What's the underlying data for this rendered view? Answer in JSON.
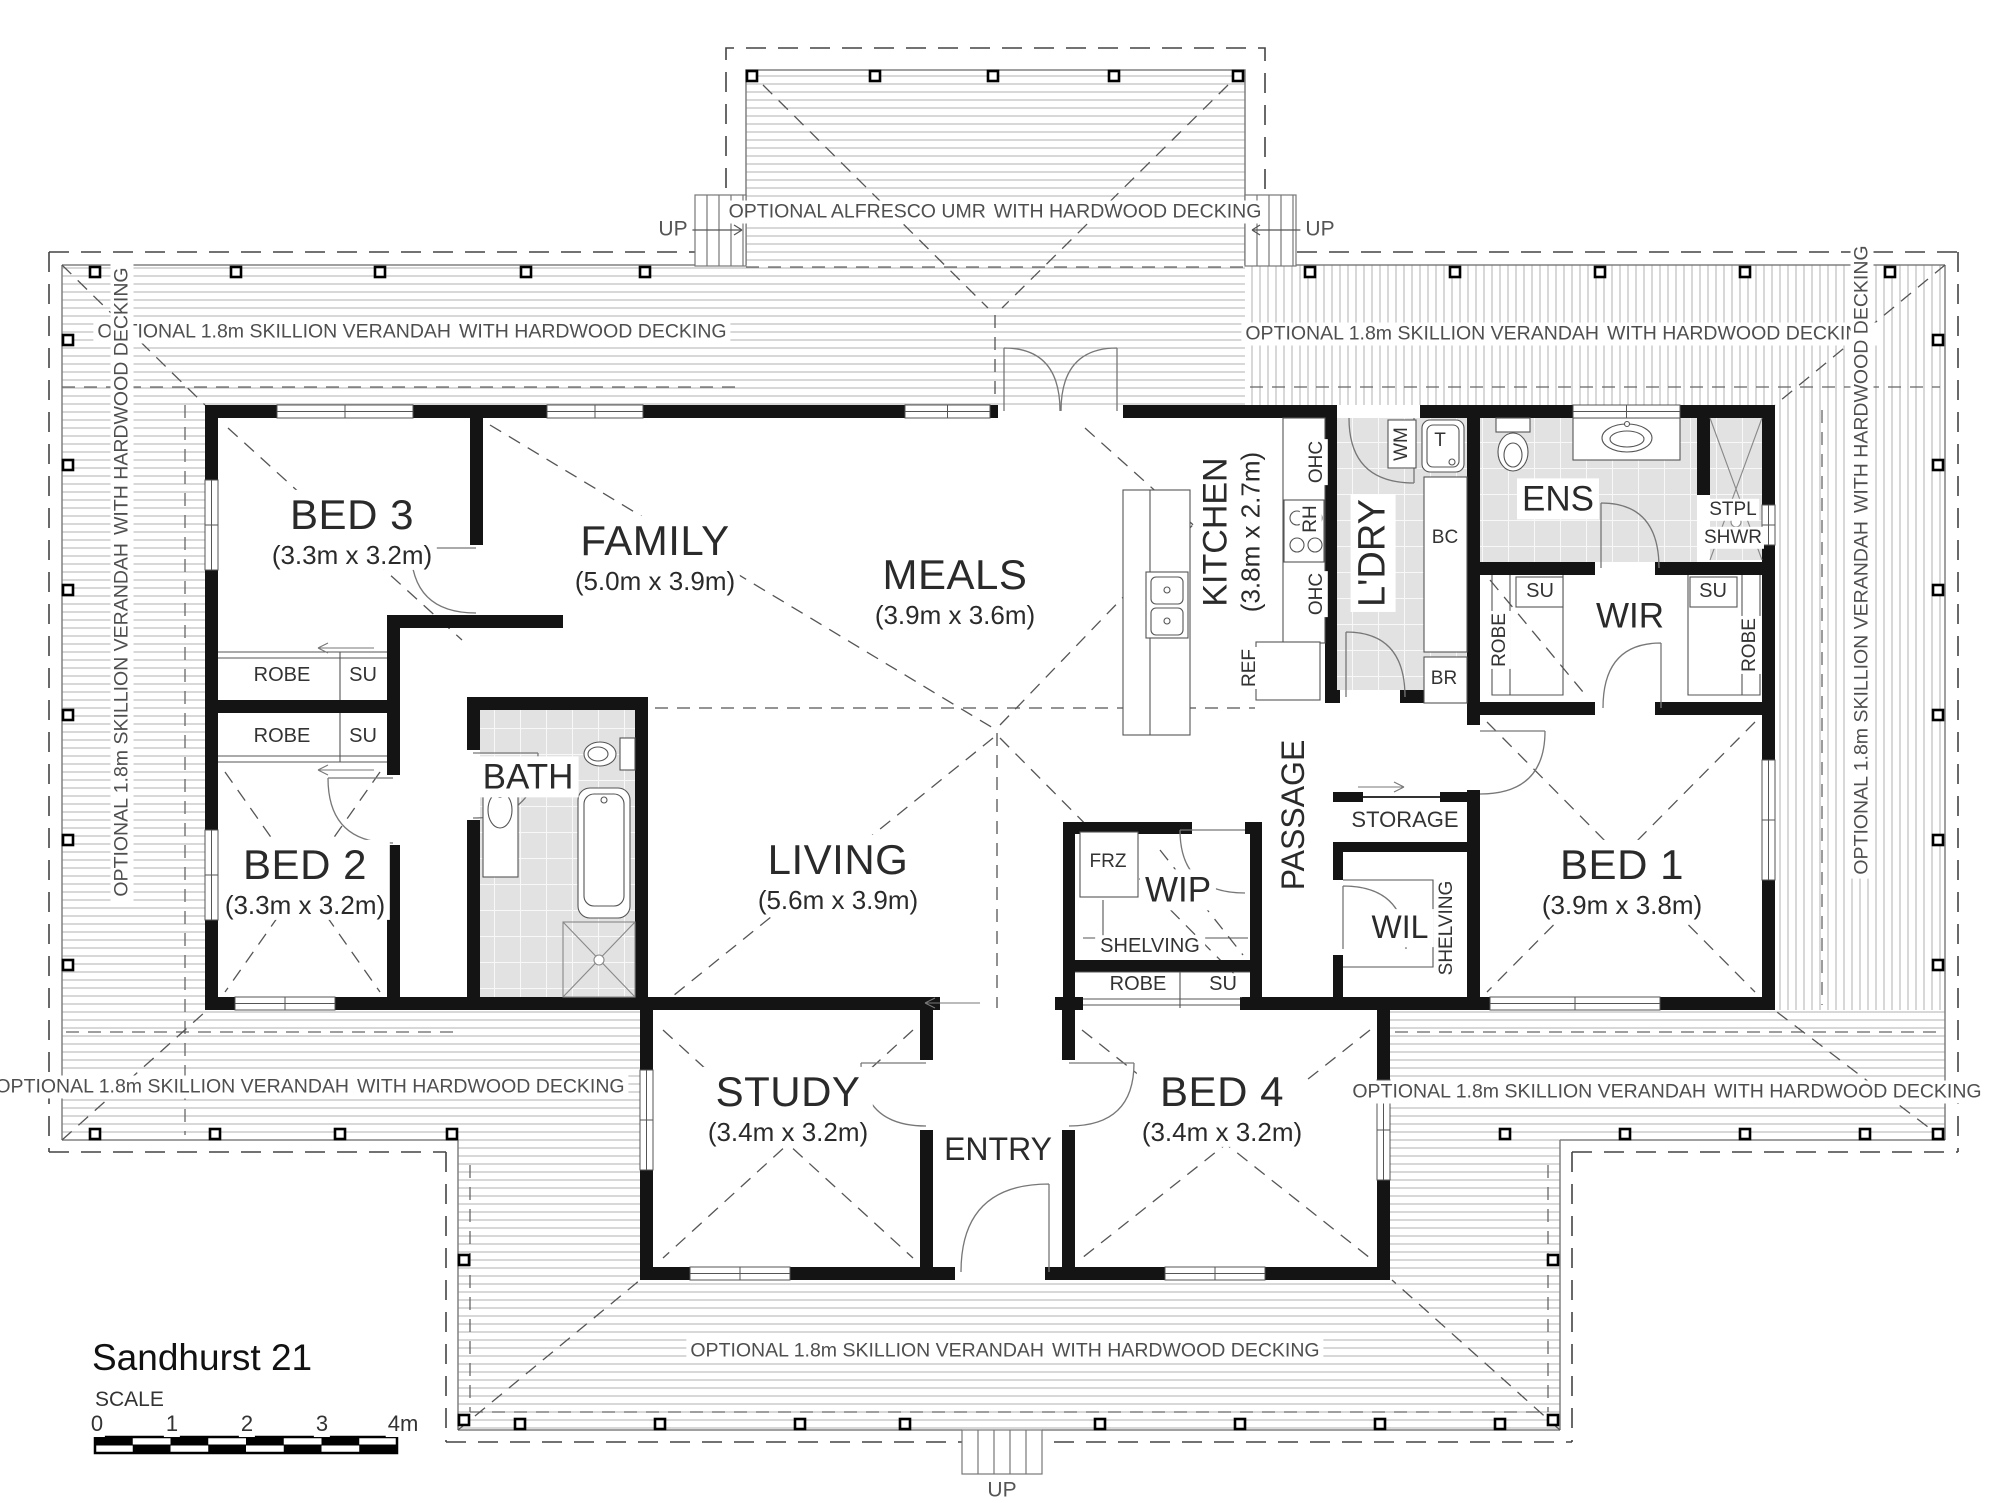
{
  "title": "Sandhurst 21",
  "scale": {
    "label": "SCALE",
    "ticks": [
      "0",
      "1",
      "2",
      "3",
      "4m"
    ]
  },
  "verandah": {
    "line1": "OPTIONAL 1.8m SKILLION VERANDAH",
    "line2": "WITH HARDWOOD DECKING"
  },
  "alfresco": {
    "line1": "OPTIONAL ALFRESCO UMR",
    "line2": "WITH HARDWOOD DECKING"
  },
  "stairs": {
    "up": "UP"
  },
  "rooms": {
    "bed3": {
      "name": "BED 3",
      "dims": "(3.3m x 3.2m)"
    },
    "family": {
      "name": "FAMILY",
      "dims": "(5.0m x 3.9m)"
    },
    "meals": {
      "name": "MEALS",
      "dims": "(3.9m x 3.6m)"
    },
    "kitchen": {
      "name": "KITCHEN",
      "dims": "(3.8m x 2.7m)"
    },
    "laundry": {
      "name": "L'DRY"
    },
    "ens": {
      "name": "ENS"
    },
    "wir": {
      "name": "WIR"
    },
    "bed2": {
      "name": "BED 2",
      "dims": "(3.3m x 3.2m)"
    },
    "bath": {
      "name": "BATH"
    },
    "living": {
      "name": "LIVING",
      "dims": "(5.6m x 3.9m)"
    },
    "passage": {
      "name": "PASSAGE"
    },
    "storage": {
      "name": "STORAGE"
    },
    "wil": {
      "name": "WIL"
    },
    "wip": {
      "name": "WIP"
    },
    "bed1": {
      "name": "BED 1",
      "dims": "(3.9m x 3.8m)"
    },
    "study": {
      "name": "STUDY",
      "dims": "(3.4m x 3.2m)"
    },
    "entry": {
      "name": "ENTRY"
    },
    "bed4": {
      "name": "BED 4",
      "dims": "(3.4m x 3.2m)"
    }
  },
  "fixtures": {
    "robe": "ROBE",
    "su": "SU",
    "shelving": "SHELVING",
    "wm": "WM",
    "tub": "T",
    "bc": "BC",
    "br": "BR",
    "frz": "FRZ",
    "ref": "REF",
    "ohc": "OHC",
    "rh": "RH",
    "stpl": "STPL",
    "shwr": "SHWR"
  },
  "colors": {
    "wall": "#141414",
    "decking_line": "#b0b0b0",
    "tile": "#e2e2e2",
    "dash": "#555555"
  }
}
